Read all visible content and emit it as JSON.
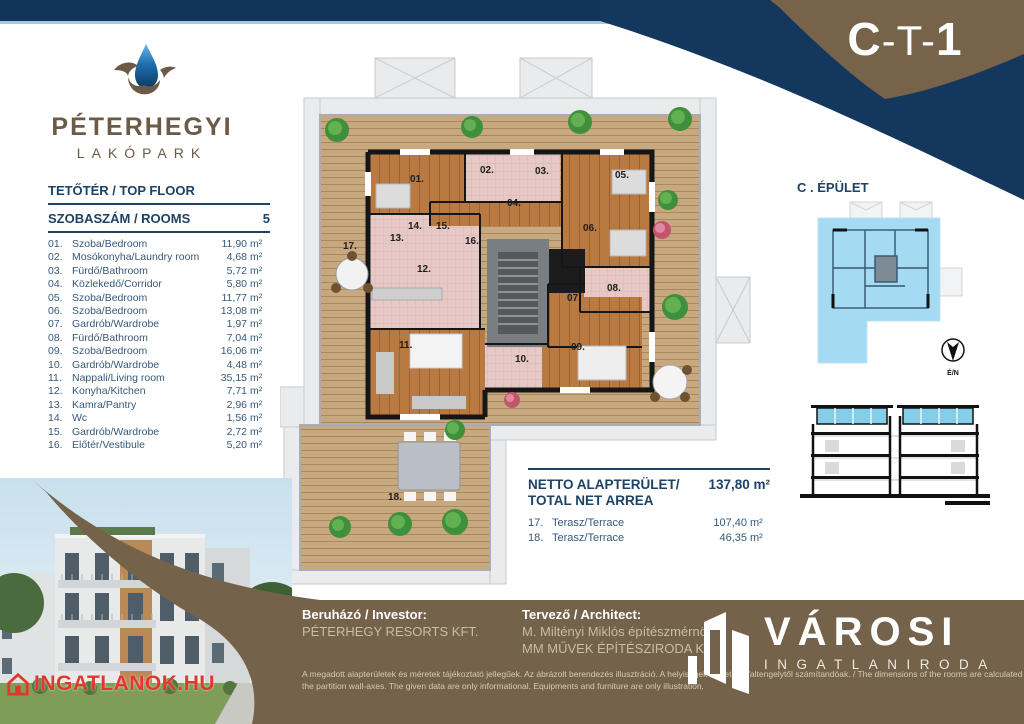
{
  "page": {
    "code_c": "C",
    "code_t": "-T-",
    "code_n": "1"
  },
  "logo": {
    "title": "PÉTERHEGYI",
    "subtitle": "LAKÓPARK"
  },
  "room_table": {
    "title": "TETŐTÉR / TOP FLOOR",
    "header_label": "SZOBASZÁM / ROOMS",
    "header_value": "5",
    "unit": "m²",
    "rows": [
      {
        "num": "01.",
        "name": "Szoba/Bedroom",
        "area": "11,90"
      },
      {
        "num": "02.",
        "name": "Mosókonyha/Laundry room",
        "area": "4,68"
      },
      {
        "num": "03.",
        "name": "Fürdő/Bathroom",
        "area": "5,72"
      },
      {
        "num": "04.",
        "name": "Közlekedő/Corridor",
        "area": "5,80"
      },
      {
        "num": "05.",
        "name": "Szoba/Bedroom",
        "area": "11,77"
      },
      {
        "num": "06.",
        "name": "Szoba/Bedroom",
        "area": "13,08"
      },
      {
        "num": "07.",
        "name": "Gardrób/Wardrobe",
        "area": "1,97"
      },
      {
        "num": "08.",
        "name": "Fürdő/Bathroom",
        "area": "7,04"
      },
      {
        "num": "09.",
        "name": "Szoba/Bedroom",
        "area": "16,06"
      },
      {
        "num": "10.",
        "name": "Gardrób/Wardrobe",
        "area": "4,48"
      },
      {
        "num": "11.",
        "name": "Nappali/Living room",
        "area": "35,15"
      },
      {
        "num": "12.",
        "name": "Konyha/Kitchen",
        "area": "7,71"
      },
      {
        "num": "13.",
        "name": "Kamra/Pantry",
        "area": "2,96"
      },
      {
        "num": "14.",
        "name": "Wc",
        "area": "1,56"
      },
      {
        "num": "15.",
        "name": "Gardrób/Wardrobe",
        "area": "2,72"
      },
      {
        "num": "16.",
        "name": "Előtér/Vestibule",
        "area": "5,20"
      }
    ]
  },
  "net_area": {
    "label_line1": "NETTO ALAPTERÜLET/",
    "label_line2": "TOTAL NET ARREA",
    "value": "137,80",
    "unit": "m²",
    "rows": [
      {
        "num": "17.",
        "name": "Terasz/Terrace",
        "area": "107,40"
      },
      {
        "num": "18.",
        "name": "Terasz/Terrace",
        "area": "46,35"
      }
    ]
  },
  "building": {
    "title": "C . ÉPÜLET",
    "compass_label": "É/N"
  },
  "plan": {
    "labels": [
      {
        "t": "01.",
        "x": 130,
        "y": 130
      },
      {
        "t": "02.",
        "x": 200,
        "y": 121
      },
      {
        "t": "03.",
        "x": 255,
        "y": 122
      },
      {
        "t": "04.",
        "x": 227,
        "y": 154
      },
      {
        "t": "05.",
        "x": 335,
        "y": 126
      },
      {
        "t": "06.",
        "x": 303,
        "y": 179
      },
      {
        "t": "07.",
        "x": 287,
        "y": 249
      },
      {
        "t": "08.",
        "x": 327,
        "y": 239
      },
      {
        "t": "09.",
        "x": 291,
        "y": 298
      },
      {
        "t": "10.",
        "x": 235,
        "y": 310
      },
      {
        "t": "11.",
        "x": 119,
        "y": 296
      },
      {
        "t": "12.",
        "x": 137,
        "y": 220
      },
      {
        "t": "13.",
        "x": 110,
        "y": 189
      },
      {
        "t": "14.",
        "x": 128,
        "y": 177
      },
      {
        "t": "15.",
        "x": 156,
        "y": 177
      },
      {
        "t": "16.",
        "x": 185,
        "y": 192
      },
      {
        "t": "17.",
        "x": 63,
        "y": 197
      },
      {
        "t": "18.",
        "x": 108,
        "y": 448
      }
    ]
  },
  "footer": {
    "investor_label": "Beruházó / Investor:",
    "investor_name": "PÉTERHEGY RESORTS KFT.",
    "architect_label": "Tervező / Architect:",
    "architect_line1": "M. Miltényi Miklós építészmérnök",
    "architect_line2": "MM MŰVEK ÉPÍTÉSZIRODA KFT.",
    "disclaimer_line1": "A megadott alapterületek és méretek tájékoztató jellegűek. Az ábrázolt berendezés illusztráció. A helyiségek méretei a faltengelytől számítandóak. / The dimensions of the rooms are calculated according to",
    "disclaimer_line2": "the partition wall-axes. The given data are only informational. Equipments and furniture are only illustration.",
    "brand_name": "VÁROSI",
    "brand_sub": "INGATLANIRODA"
  },
  "watermark": "INGATLANOK.HU",
  "colors": {
    "navy": "#10345a",
    "brown": "#76634a",
    "heading": "#1c4266",
    "map_blue": "#a5daf3",
    "accent_red": "#e0372e"
  }
}
